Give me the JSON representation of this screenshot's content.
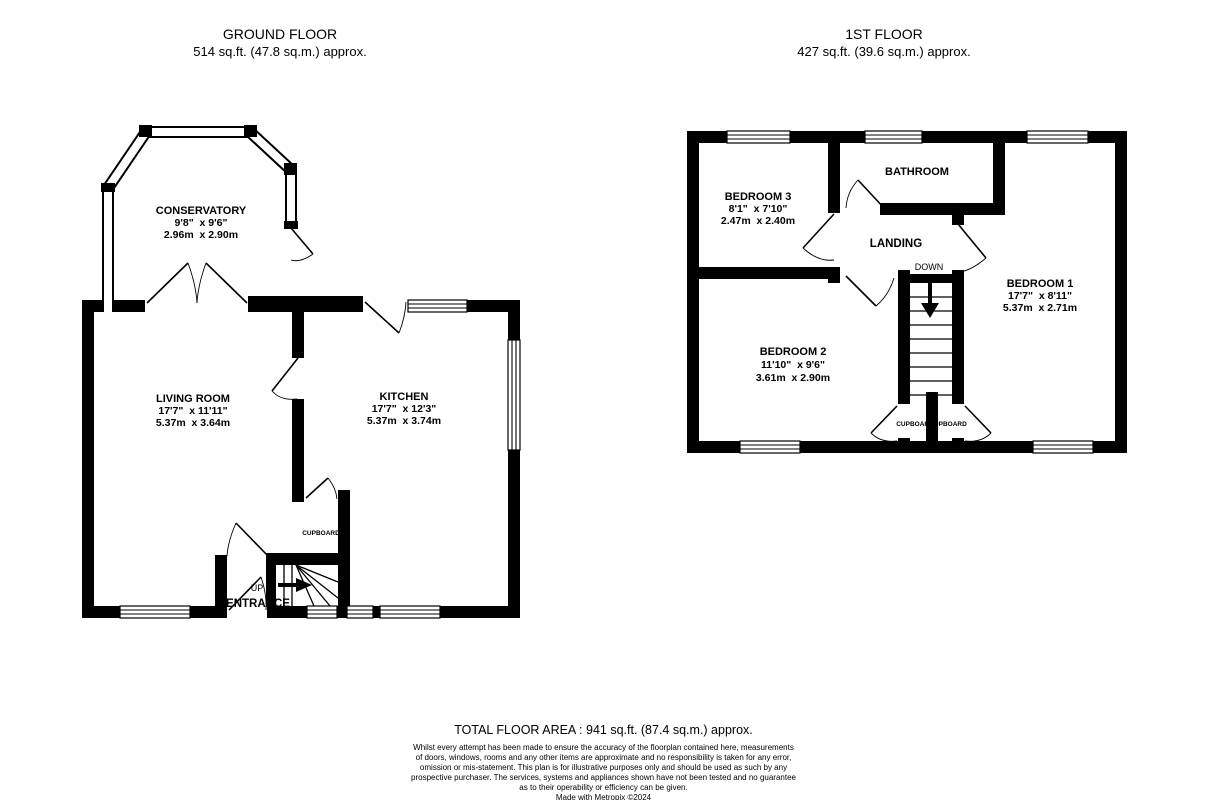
{
  "header": {
    "ground": {
      "title": "GROUND FLOOR",
      "area": "514 sq.ft. (47.8 sq.m.) approx."
    },
    "first": {
      "title": "1ST FLOOR",
      "area": "427 sq.ft. (39.6 sq.m.) approx."
    }
  },
  "ground_floor": {
    "conservatory": {
      "name": "CONSERVATORY",
      "imperial": "9'8\"  x 9'6\"",
      "metric": "2.96m  x 2.90m"
    },
    "living_room": {
      "name": "LIVING ROOM",
      "imperial": "17'7\"  x 11'11\"",
      "metric": "5.37m  x 3.64m"
    },
    "kitchen": {
      "name": "KITCHEN",
      "imperial": "17'7\"  x 12'3\"",
      "metric": "5.37m  x 3.74m"
    },
    "cupboard": "CUPBOARD",
    "up": "UP",
    "entrance": "ENTRANCE"
  },
  "first_floor": {
    "bedroom1": {
      "name": "BEDROOM 1",
      "imperial": "17'7\"  x 8'11\"",
      "metric": "5.37m  x 2.71m"
    },
    "bedroom2": {
      "name": "BEDROOM 2",
      "imperial": "11'10\"  x 9'6\"",
      "metric": "3.61m  x 2.90m"
    },
    "bedroom3": {
      "name": "BEDROOM 3",
      "imperial": "8'1\"  x 7'10\"",
      "metric": "2.47m  x 2.40m"
    },
    "bathroom": "BATHROOM",
    "landing": "LANDING",
    "down": "DOWN",
    "cupboard_left": "CUPBOARD",
    "cupboard_right": "CUPBOARD"
  },
  "footer": {
    "total": "TOTAL FLOOR AREA : 941 sq.ft. (87.4 sq.m.) approx.",
    "disclaimer_lines": [
      "Whilst every attempt has been made to ensure the accuracy of the floorplan contained here, measurements",
      "of doors, windows, rooms and any other items are approximate and no responsibility is taken for any error,",
      "omission or mis-statement. This plan is for illustrative purposes only and should be used as such by any",
      "prospective purchaser. The services, systems and appliances shown have not been tested and no guarantee",
      "as to their operability or efficiency can be given."
    ],
    "credit": "Made with Metropix ©2024"
  },
  "colors": {
    "wall": "#000000",
    "background": "#ffffff"
  }
}
